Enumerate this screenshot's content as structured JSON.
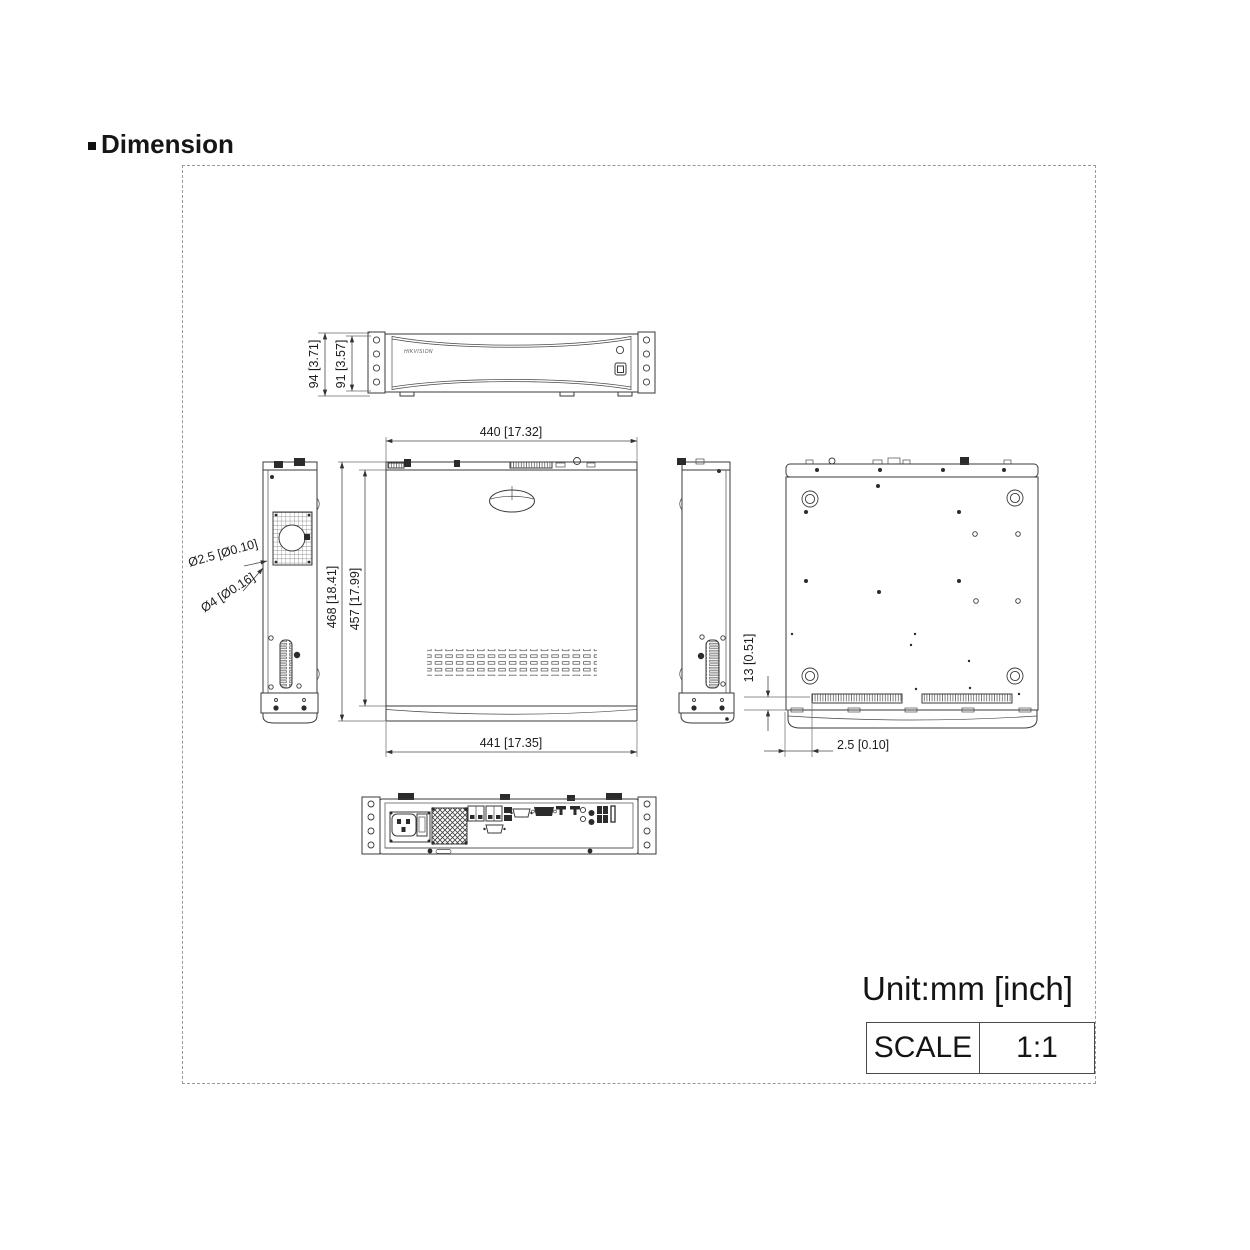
{
  "title": "Dimension",
  "logo": "HIKVISION",
  "dims": {
    "front_height_outer": "94 [3.71]",
    "front_height_inner": "91 [3.57]",
    "top_width": "440 [17.32]",
    "bottom_width": "441 [17.35]",
    "depth_outer": "468 [18.41]",
    "depth_inner": "457 [17.99]",
    "screw_hole_small": "Ø2.5 [Ø0.10]",
    "screw_hole_large": "Ø4 [Ø0.16]",
    "foot_height": "13 [0.51]",
    "foot_offset": "2.5 [0.10]"
  },
  "footer": {
    "unit": "Unit:mm [inch]",
    "scale_label": "SCALE",
    "scale_value": "1:1"
  }
}
